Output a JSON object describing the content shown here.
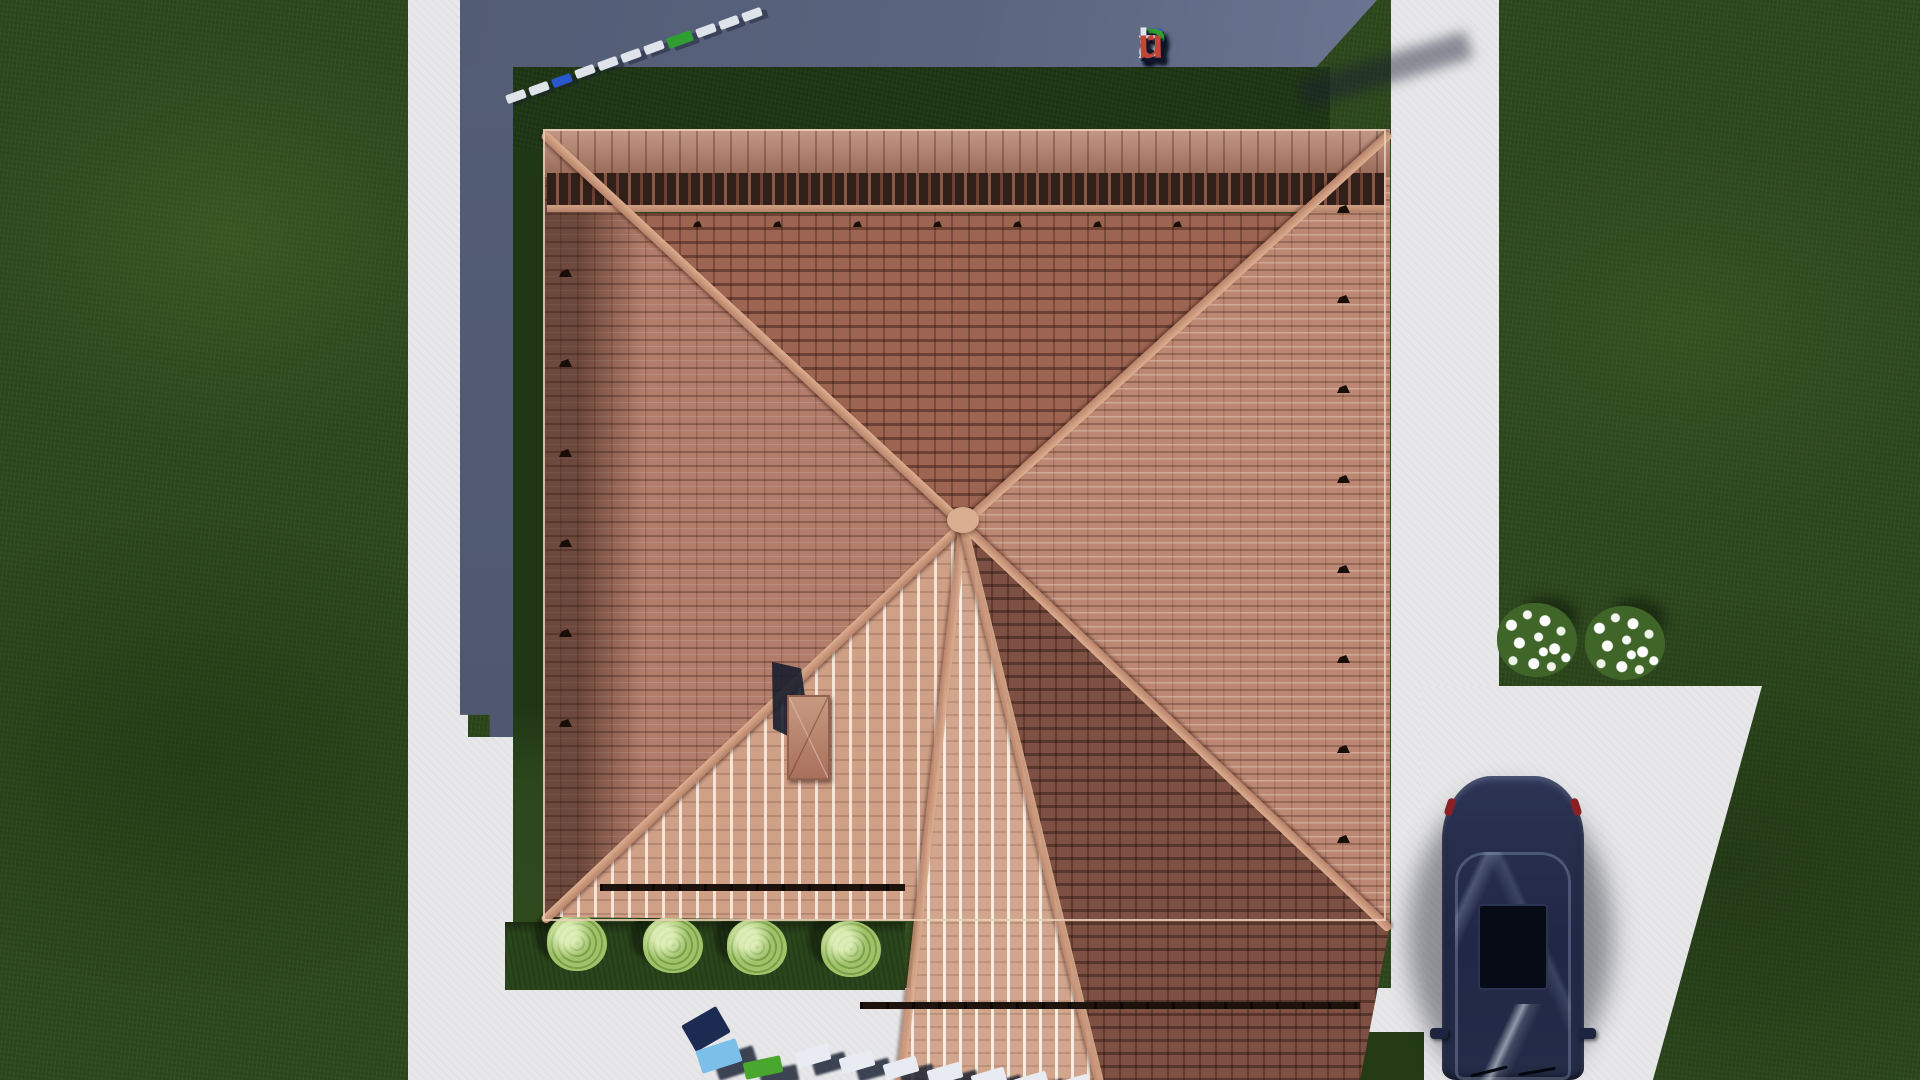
{
  "watermark": {
    "text": "FixPlans.ru",
    "letters": [
      {
        "ch": "F",
        "color": "#2a57cc"
      },
      {
        "ch": "i",
        "color": "#2f9e33"
      },
      {
        "ch": "x",
        "color": "#dfe4ee"
      },
      {
        "ch": "P",
        "color": "#2f9e33"
      },
      {
        "ch": "l",
        "color": "#dfe4ee"
      },
      {
        "ch": "a",
        "color": "#dfe4ee"
      },
      {
        "ch": "n",
        "color": "#dfe4ee"
      },
      {
        "ch": "s",
        "color": "#dfe4ee"
      },
      {
        "ch": ".",
        "color": "#2a57cc"
      },
      {
        "ch": "r",
        "color": "#c2453a"
      },
      {
        "ch": "u",
        "color": "#c2453a"
      }
    ]
  },
  "scene": {
    "description": "Top-down aerial 3D render of a house with a terracotta hip roof, shaded lawn, concrete walkways, driveway with a dark navy car, two white flower shrubs and four trimmed light-green bushes; building shadow falls to the upper left",
    "objects": {
      "roof": "terracotta tiled hip roof with central wing, chimney, decorative ridge crest, snow guards and gutters",
      "car": "dark navy sedan parked on the driveway, viewed from above, facing down",
      "lawn": "green grass lot",
      "paths": "light concrete walkways and driveway",
      "shadow": "slate-blue building shadow band at upper left",
      "flowers": "two white flowering shrubs beside the right walkway",
      "bushes": "four light-green trimmed shrubs along the south lawn strip"
    },
    "colors": {
      "grass": "#2e481d",
      "grass_shaded": "#203716",
      "pavement": "#e7e7e9",
      "shadow_slate": "#59627b",
      "roof_light": "#d2a68c",
      "roof_mid": "#b27d6a",
      "roof_dark": "#9d6452",
      "roof_shade": "#7d5043",
      "ridge_board": "#cfa183",
      "car_body": "#252d4a",
      "bush": "#9fc468",
      "flower": "#ffffff"
    }
  },
  "chips_top": {
    "colors": [
      "#dfe3ea",
      "#dfe3ea",
      "#2a57cc",
      "#dfe3ea",
      "#dfe3ea",
      "#dfe3ea",
      "#dfe3ea",
      "#2f9e33",
      "#dfe3ea",
      "#dfe3ea",
      "#dfe3ea"
    ]
  },
  "chips_bottom": {
    "colors": [
      "#1c2b52",
      "#7cc0ea",
      "#49a62f",
      "#e8ecf2",
      "#e8ecf2",
      "#e8ecf2",
      "#e8ecf2",
      "#e8ecf2",
      "#e8ecf2",
      "#e8ecf2"
    ]
  }
}
